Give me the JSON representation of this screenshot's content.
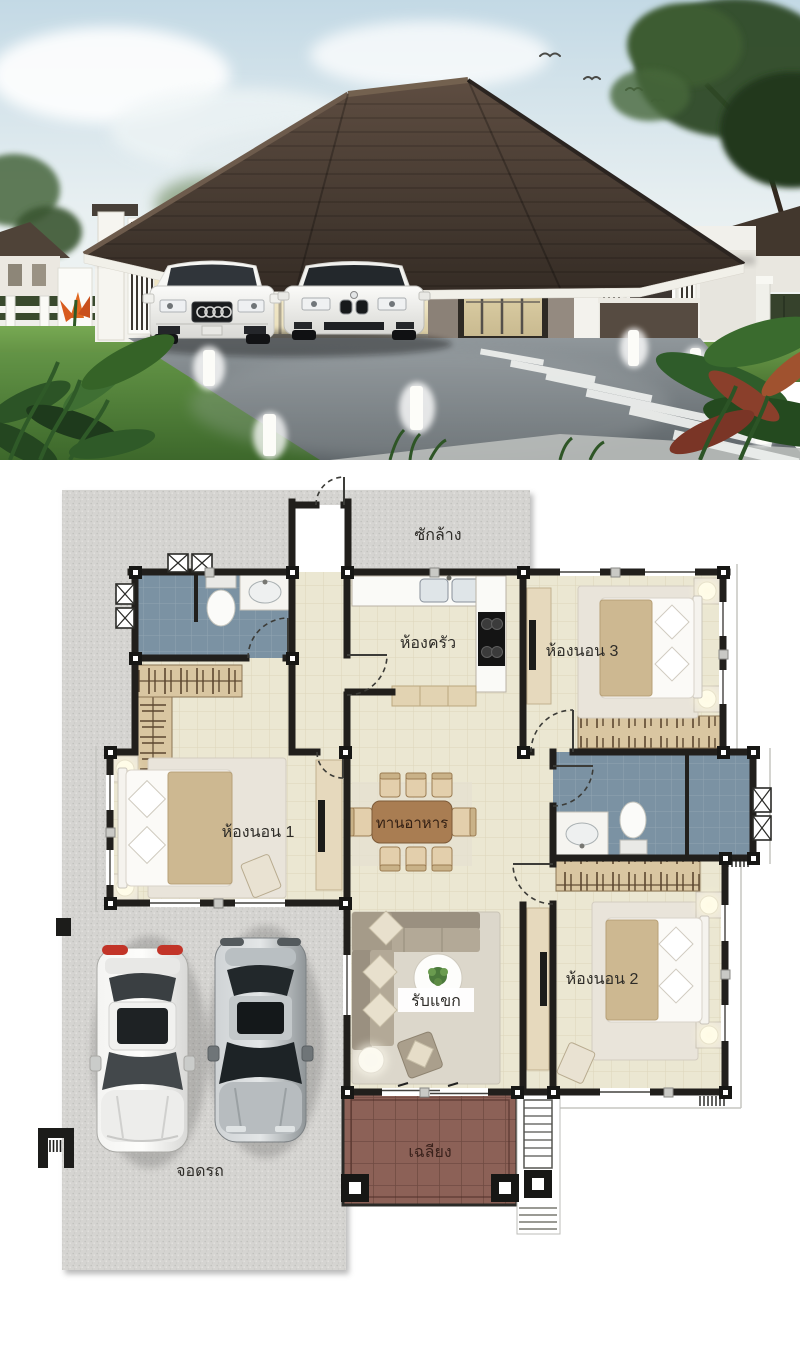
{
  "sheet": {
    "type": "house-design-sheet",
    "sections": [
      "exterior-render",
      "floor-plan"
    ]
  },
  "render": {
    "colors": {
      "sky": "#c8dce7",
      "roof": "#4a3b31",
      "wall": "#f2f1ec",
      "glow": "#efe3ba",
      "grass": "#5d9140",
      "driveway": "#7d8487"
    }
  },
  "floor_plan": {
    "labels": {
      "laundry": "ซักล้าง",
      "kitchen": "ห้องครัว",
      "bedroom3": "ห้องนอน 3",
      "bedroom1": "ห้องนอน 1",
      "dining": "ทานอาหาร",
      "living": "รับแขก",
      "bedroom2": "ห้องนอน 2",
      "porch": "เฉลียง",
      "parking": "จอดรถ"
    },
    "colors": {
      "floor": "#ebe7d2",
      "wet_floor": "#7b92a3",
      "wall": "#211f1c",
      "wardrobe": "#d9c6a1",
      "porch_tile": "#8c6157",
      "paving": "#d4d4d2",
      "dining_table": "#a97d52"
    }
  }
}
